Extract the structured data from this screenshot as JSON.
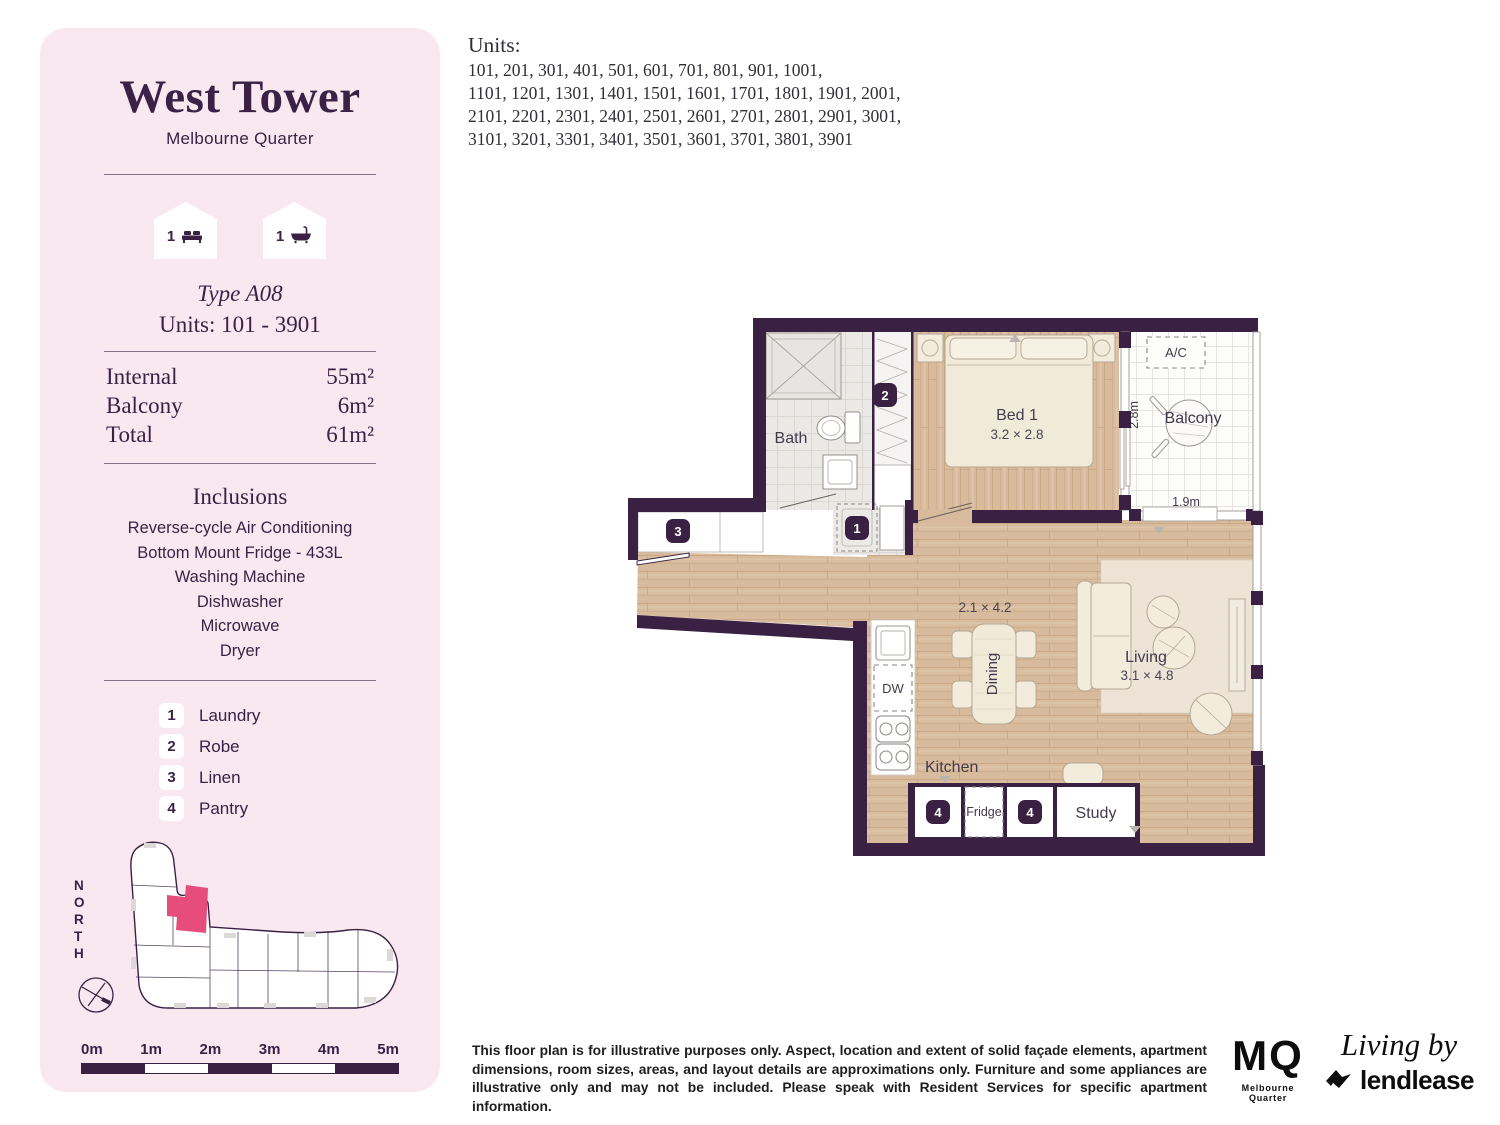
{
  "colors": {
    "wall": "#3a2144",
    "sidebar_bg": "#f9e8f0",
    "accent_pink": "#e64d7d",
    "wood": "#d8bb9c"
  },
  "sidebar": {
    "title": "West Tower",
    "subtitle": "Melbourne Quarter",
    "bed_badge": "1",
    "bath_badge": "1",
    "type_label": "Type A08",
    "units_range": "Units: 101 - 3901",
    "areas": [
      {
        "label": "Internal",
        "value": "55m²"
      },
      {
        "label": "Balcony",
        "value": "6m²"
      },
      {
        "label": "Total",
        "value": "61m²"
      }
    ],
    "inclusions_title": "Inclusions",
    "inclusions": [
      "Reverse-cycle Air Conditioning",
      "Bottom Mount Fridge - 433L",
      "Washing Machine",
      "Dishwasher",
      "Microwave",
      "Dryer"
    ],
    "legend": [
      {
        "num": "1",
        "label": "Laundry"
      },
      {
        "num": "2",
        "label": "Robe"
      },
      {
        "num": "3",
        "label": "Linen"
      },
      {
        "num": "4",
        "label": "Pantry"
      }
    ],
    "north_label": "NORTH",
    "scale_labels": [
      "0m",
      "1m",
      "2m",
      "3m",
      "4m",
      "5m"
    ]
  },
  "units_block": {
    "heading": "Units:",
    "lines": [
      "101, 201, 301, 401, 501, 601, 701, 801, 901, 1001,",
      "1101, 1201, 1301, 1401, 1501, 1601, 1701, 1801, 1901, 2001,",
      "2101, 2201, 2301, 2401, 2501, 2601, 2701, 2801, 2901, 3001,",
      "3101, 3201, 3301, 3401, 3501, 3601, 3701, 3801, 3901"
    ]
  },
  "floorplan": {
    "bath": "Bath",
    "bed": "Bed 1",
    "bed_dim": "3.2 × 2.8",
    "balcony": "Balcony",
    "balcony_depth": "2.8m",
    "balcony_width": "1.9m",
    "ac": "A/C",
    "dining": "Dining",
    "dining_dim": "2.1 × 4.2",
    "living": "Living",
    "living_dim": "3.1 × 4.8",
    "kitchen": "Kitchen",
    "dw": "DW",
    "fridge": "Fridge",
    "study": "Study",
    "markers": {
      "laundry": "1",
      "robe": "2",
      "linen": "3",
      "pantry_a": "4",
      "pantry_b": "4"
    }
  },
  "footer": {
    "disclaimer": "This floor plan is for illustrative purposes only. Aspect, location and extent of solid façade elements, apartment dimensions, room sizes, areas, and layout details are approximations only. Furniture and some appliances are illustrative only and may not be included. Please speak with Resident Services for specific apartment information.",
    "mq_logo": "MQ",
    "mq_sub": "Melbourne Quarter",
    "living_by": "Living by",
    "lendlease": "lendlease"
  }
}
